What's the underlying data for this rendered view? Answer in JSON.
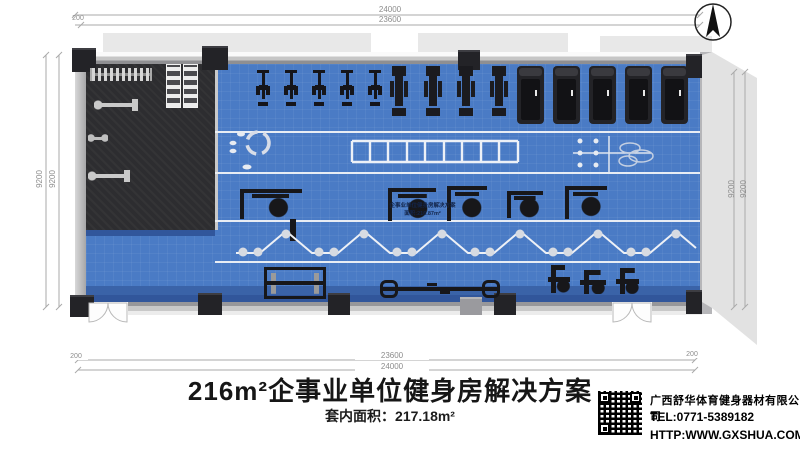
{
  "dimensions": {
    "top_outer": "24000",
    "top_inner": "23600",
    "bottom_inner": "23600",
    "bottom_outer": "24000",
    "left_outer": "9200",
    "left_inner": "9200",
    "right_inner": "9200",
    "right_outer": "9200",
    "offset_top_left": "200",
    "offset_bottom_left": "200",
    "offset_bottom_right": "200"
  },
  "floorplan": {
    "floor_text": {
      "line1": "企事业单位健身房解决方案",
      "line2": "面积:216.87m²"
    },
    "equipment": [
      {
        "type": "bike",
        "x": 256,
        "y": 70,
        "w": 14,
        "h": 36
      },
      {
        "type": "bike",
        "x": 284,
        "y": 70,
        "w": 14,
        "h": 36
      },
      {
        "type": "bike",
        "x": 312,
        "y": 70,
        "w": 14,
        "h": 36
      },
      {
        "type": "bike",
        "x": 340,
        "y": 70,
        "w": 14,
        "h": 36
      },
      {
        "type": "bike",
        "x": 368,
        "y": 70,
        "w": 14,
        "h": 36
      },
      {
        "type": "elliptical",
        "x": 390,
        "y": 66,
        "w": 18,
        "h": 50
      },
      {
        "type": "elliptical",
        "x": 424,
        "y": 66,
        "w": 18,
        "h": 50
      },
      {
        "type": "elliptical",
        "x": 457,
        "y": 66,
        "w": 18,
        "h": 50
      },
      {
        "type": "elliptical",
        "x": 490,
        "y": 66,
        "w": 18,
        "h": 50
      },
      {
        "type": "treadmill",
        "x": 517,
        "y": 66,
        "w": 27,
        "h": 58
      },
      {
        "type": "treadmill",
        "x": 553,
        "y": 66,
        "w": 27,
        "h": 58
      },
      {
        "type": "treadmill",
        "x": 589,
        "y": 66,
        "w": 27,
        "h": 58
      },
      {
        "type": "treadmill",
        "x": 625,
        "y": 66,
        "w": 27,
        "h": 58
      },
      {
        "type": "treadmill",
        "x": 661,
        "y": 66,
        "w": 27,
        "h": 58
      },
      {
        "type": "plate-rack",
        "x": 90,
        "y": 68,
        "w": 58,
        "h": 13
      },
      {
        "type": "dumbbell-rack",
        "x": 166,
        "y": 64,
        "w": 13,
        "h": 42
      },
      {
        "type": "dumbbell-rack",
        "x": 183,
        "y": 64,
        "w": 13,
        "h": 42
      },
      {
        "type": "bench",
        "x": 94,
        "y": 99,
        "w": 44,
        "h": 12
      },
      {
        "type": "dumbbell",
        "x": 88,
        "y": 133,
        "w": 20,
        "h": 10
      },
      {
        "type": "bench",
        "x": 88,
        "y": 170,
        "w": 42,
        "h": 12
      },
      {
        "type": "machine",
        "x": 240,
        "y": 189,
        "w": 62,
        "h": 30
      },
      {
        "type": "pole",
        "x": 290,
        "y": 219,
        "w": 6,
        "h": 22
      },
      {
        "type": "machine",
        "x": 388,
        "y": 188,
        "w": 48,
        "h": 33
      },
      {
        "type": "machine",
        "x": 447,
        "y": 186,
        "w": 40,
        "h": 35
      },
      {
        "type": "machine",
        "x": 507,
        "y": 191,
        "w": 36,
        "h": 27
      },
      {
        "type": "machine",
        "x": 565,
        "y": 186,
        "w": 42,
        "h": 33
      },
      {
        "type": "rack",
        "x": 264,
        "y": 267,
        "w": 62,
        "h": 32
      },
      {
        "type": "bar-rack",
        "x": 382,
        "y": 280,
        "w": 116,
        "h": 18
      },
      {
        "type": "small-machine",
        "x": 548,
        "y": 265,
        "w": 22,
        "h": 28
      },
      {
        "type": "small-machine",
        "x": 580,
        "y": 270,
        "w": 26,
        "h": 24
      },
      {
        "type": "small-machine",
        "x": 616,
        "y": 268,
        "w": 23,
        "h": 26
      }
    ]
  },
  "footer": {
    "title": "216m²企事业单位健身房解决方案",
    "subtitle": "套内面积：217.18m²",
    "company": {
      "name": "广西舒华体育健身器材有限公司",
      "tel": "TEL:0771-5389182",
      "web": "HTTP:WWW.GXSHUA.COM"
    }
  },
  "colors": {
    "floor_blue": "#4a7bc5",
    "floor_dark": "#2d2d30",
    "wall_gray": "#c8c8c8",
    "equipment_dark": "#17171a",
    "lane_line": "#e8edf4"
  }
}
